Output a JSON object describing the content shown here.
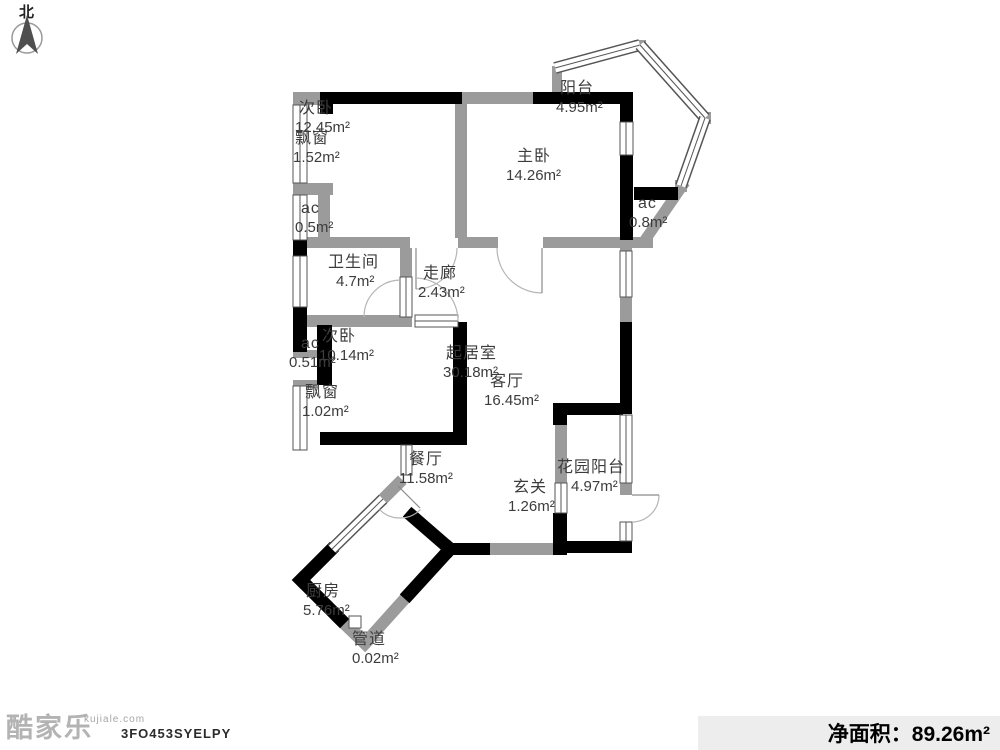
{
  "compass": {
    "north_label": "北"
  },
  "colors": {
    "wall_black": "#000000",
    "wall_gray": "#9b9b9b",
    "window_frame": "#555555",
    "door_arc": "#b5b5b5",
    "label_text": "#3c3c3c",
    "netarea_bar_bg": "#ededed"
  },
  "rooms": [
    {
      "name": "次卧",
      "area": "12.45m²"
    },
    {
      "name": "飘窗",
      "area": "1.52m²"
    },
    {
      "name": "阳台",
      "area": "4.95m²"
    },
    {
      "name": "主卧",
      "area": "14.26m²"
    },
    {
      "name": "ac",
      "area": "0.8m²"
    },
    {
      "name": "ac",
      "area": "0.5m²"
    },
    {
      "name": "卫生间",
      "area": "4.7m²"
    },
    {
      "name": "走廊",
      "area": "2.43m²"
    },
    {
      "name": "ac",
      "area": "0.51m²"
    },
    {
      "name": "次卧",
      "area": "10.14m²"
    },
    {
      "name": "飘窗",
      "area": "1.02m²"
    },
    {
      "name": "起居室",
      "area": "30.18m²"
    },
    {
      "name": "客厅",
      "area": "16.45m²"
    },
    {
      "name": "餐厅",
      "area": "11.58m²"
    },
    {
      "name": "玄关",
      "area": "1.26m²"
    },
    {
      "name": "花园阳台",
      "area": "4.97m²"
    },
    {
      "name": "厨房",
      "area": "5.76m²"
    },
    {
      "name": "管道",
      "area": "0.02m²"
    }
  ],
  "footer": {
    "brand": "酷家乐",
    "site": "kujiale.com",
    "plan_code": "3FO453SYELPY",
    "net_area_text": "净面积：89.26m²"
  }
}
